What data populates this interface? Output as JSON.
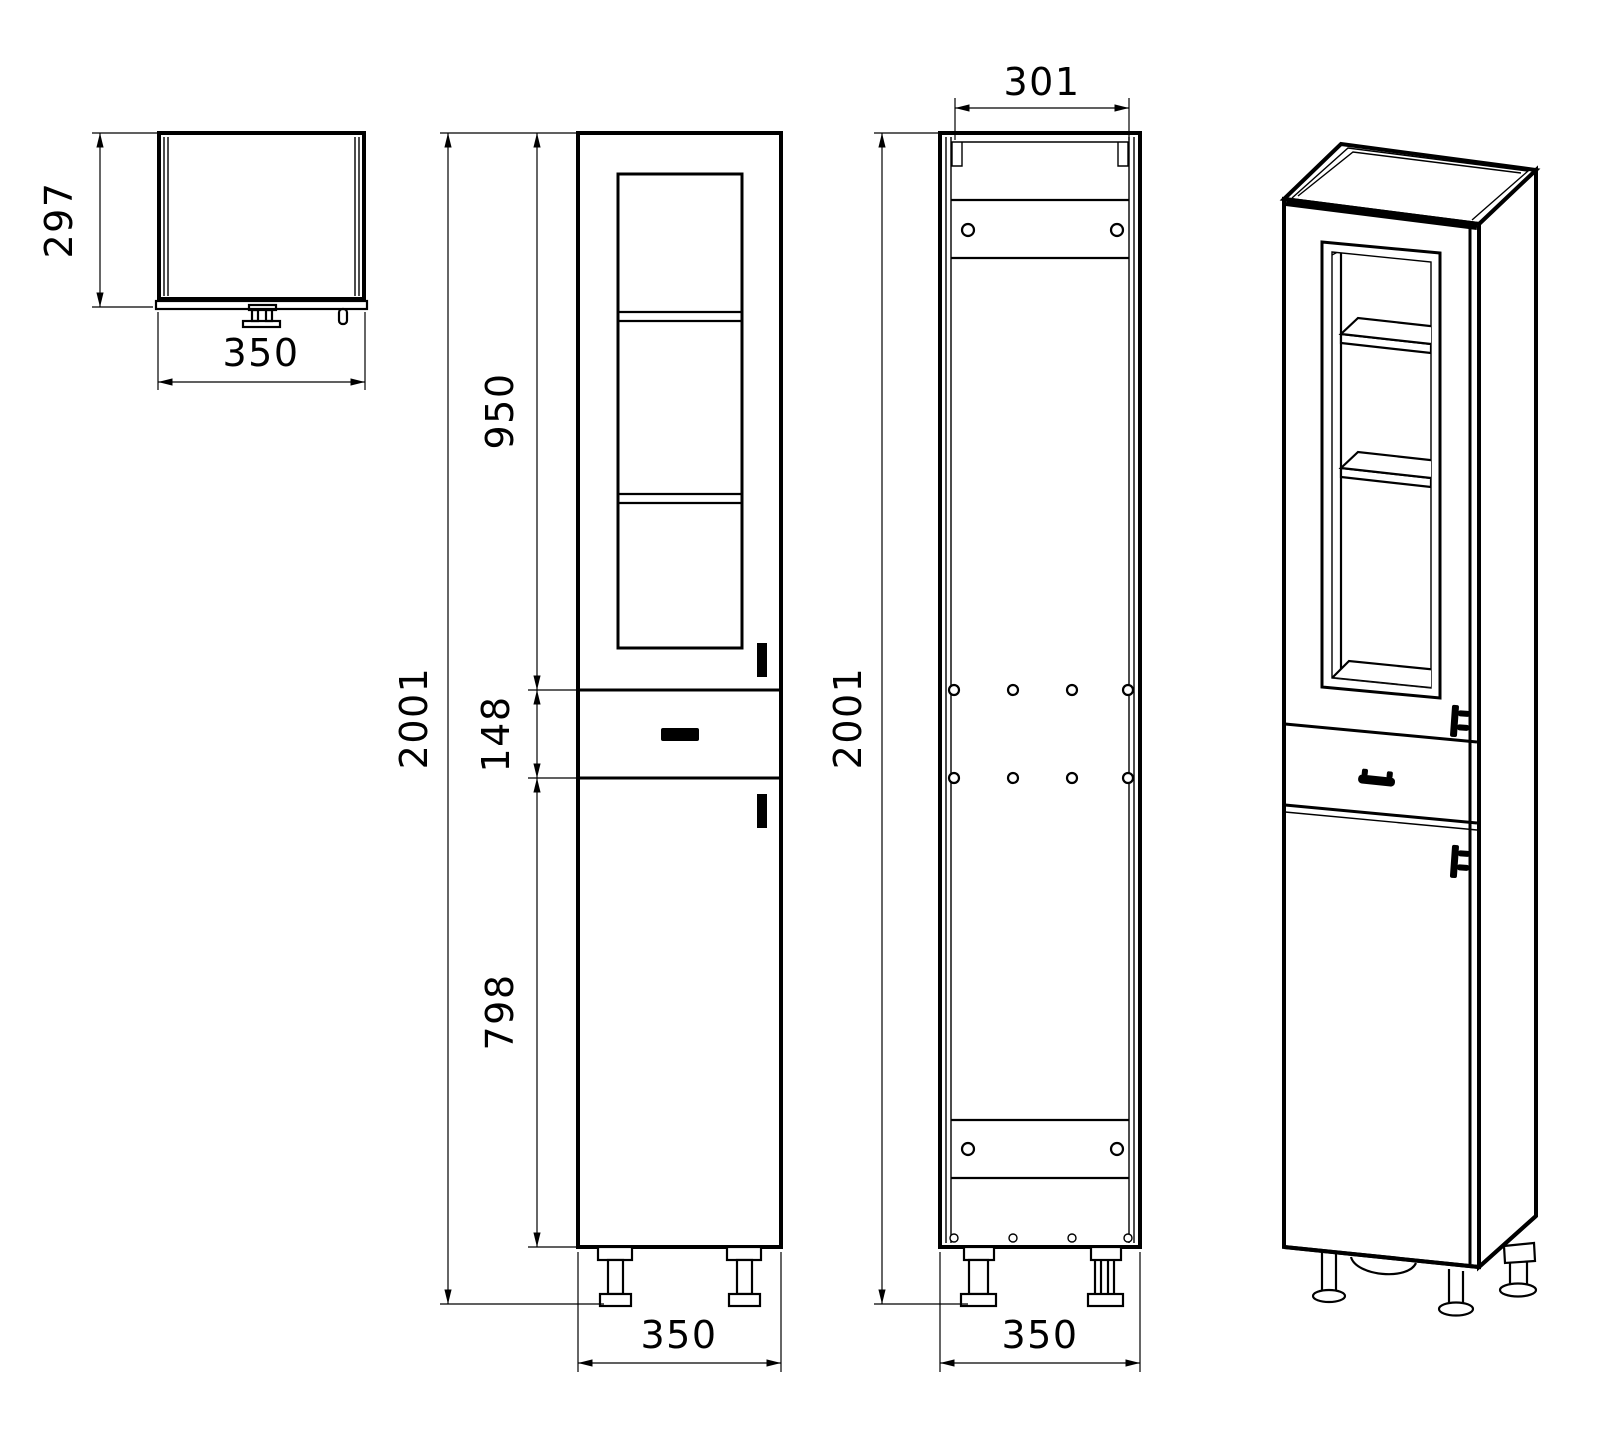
{
  "drawing": {
    "type": "technical-cabinet-drawing",
    "background_color": "#ffffff",
    "line_color": "#000000",
    "top_view": {
      "depth": "297",
      "width": "350"
    },
    "front_view": {
      "glass_door_height": "950",
      "drawer_height": "148",
      "lower_door_height": "798",
      "total_height": "2001",
      "width": "350"
    },
    "back_view": {
      "opening_width": "301",
      "total_height": "2001",
      "width": "350"
    }
  }
}
